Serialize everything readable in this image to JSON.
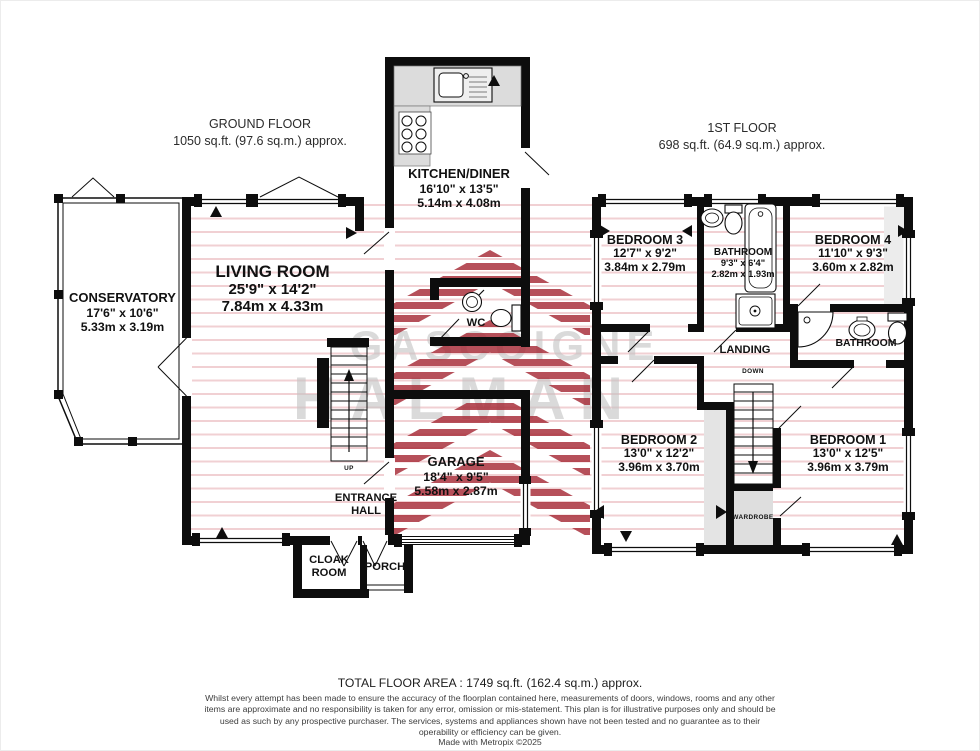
{
  "ground_floor": {
    "title": "GROUND FLOOR",
    "subtitle": "1050 sq.ft. (97.6 sq.m.) approx.",
    "rooms": {
      "conservatory": {
        "name": "CONSERVATORY",
        "imperial": "17'6\" x 10'6\"",
        "metric": "5.33m x 3.19m"
      },
      "living_room": {
        "name": "LIVING ROOM",
        "imperial": "25'9\" x 14'2\"",
        "metric": "7.84m x 4.33m"
      },
      "kitchen_diner": {
        "name": "KITCHEN/DINER",
        "imperial": "16'10\" x 13'5\"",
        "metric": "5.14m x 4.08m"
      },
      "wc": {
        "name": "WC"
      },
      "garage": {
        "name": "GARAGE",
        "imperial": "18'4\" x 9'5\"",
        "metric": "5.58m x 2.87m"
      },
      "entrance_hall": {
        "name": "ENTRANCE HALL"
      },
      "cloak_room": {
        "name": "CLOAK ROOM"
      },
      "porch": {
        "name": "PORCH"
      },
      "stair_direction": "UP"
    }
  },
  "first_floor": {
    "title": "1ST FLOOR",
    "subtitle": "698 sq.ft. (64.9 sq.m.) approx.",
    "rooms": {
      "bedroom_3": {
        "name": "BEDROOM 3",
        "imperial": "12'7\" x 9'2\"",
        "metric": "3.84m x 2.79m"
      },
      "bathroom": {
        "name": "BATHROOM",
        "imperial": "9'3\" x 6'4\"",
        "metric": "2.82m x 1.93m"
      },
      "bedroom_4": {
        "name": "BEDROOM 4",
        "imperial": "11'10\" x 9'3\"",
        "metric": "3.60m x 2.82m"
      },
      "landing": {
        "name": "LANDING"
      },
      "bathroom_2": {
        "name": "BATHROOM"
      },
      "bedroom_2": {
        "name": "BEDROOM 2",
        "imperial": "13'0\" x 12'2\"",
        "metric": "3.96m x 3.70m"
      },
      "bedroom_1": {
        "name": "BEDROOM 1",
        "imperial": "13'0\" x 12'5\"",
        "metric": "3.96m x 3.79m"
      },
      "wardrobe": {
        "name": "WARDROBE"
      },
      "stair_direction": "DOWN"
    }
  },
  "watermark": {
    "line1": "GASCOIGNE",
    "line2": "HALMAN"
  },
  "footer": {
    "total_area": "TOTAL FLOOR AREA : 1749 sq.ft. (162.4 sq.m.) approx.",
    "disclaimer": "Whilst every attempt has been made to ensure the accuracy of the floorplan contained here, measurements of doors, windows, rooms and any other items are approximate and no responsibility is taken for any error, omission or mis-statement. This plan is for illustrative purposes only and should be used as such by any prospective purchaser. The services, systems and appliances shown have not been tested and no guarantee as to their operability or efficiency can be given.",
    "credit": "Made with Metropix ©2025"
  },
  "colors": {
    "wall": "#0d0d0d",
    "brand_red": "#a62a36",
    "stripe_pink": "rgba(190,40,55,0.25)",
    "watermark_gray": "#c9c9c9"
  }
}
